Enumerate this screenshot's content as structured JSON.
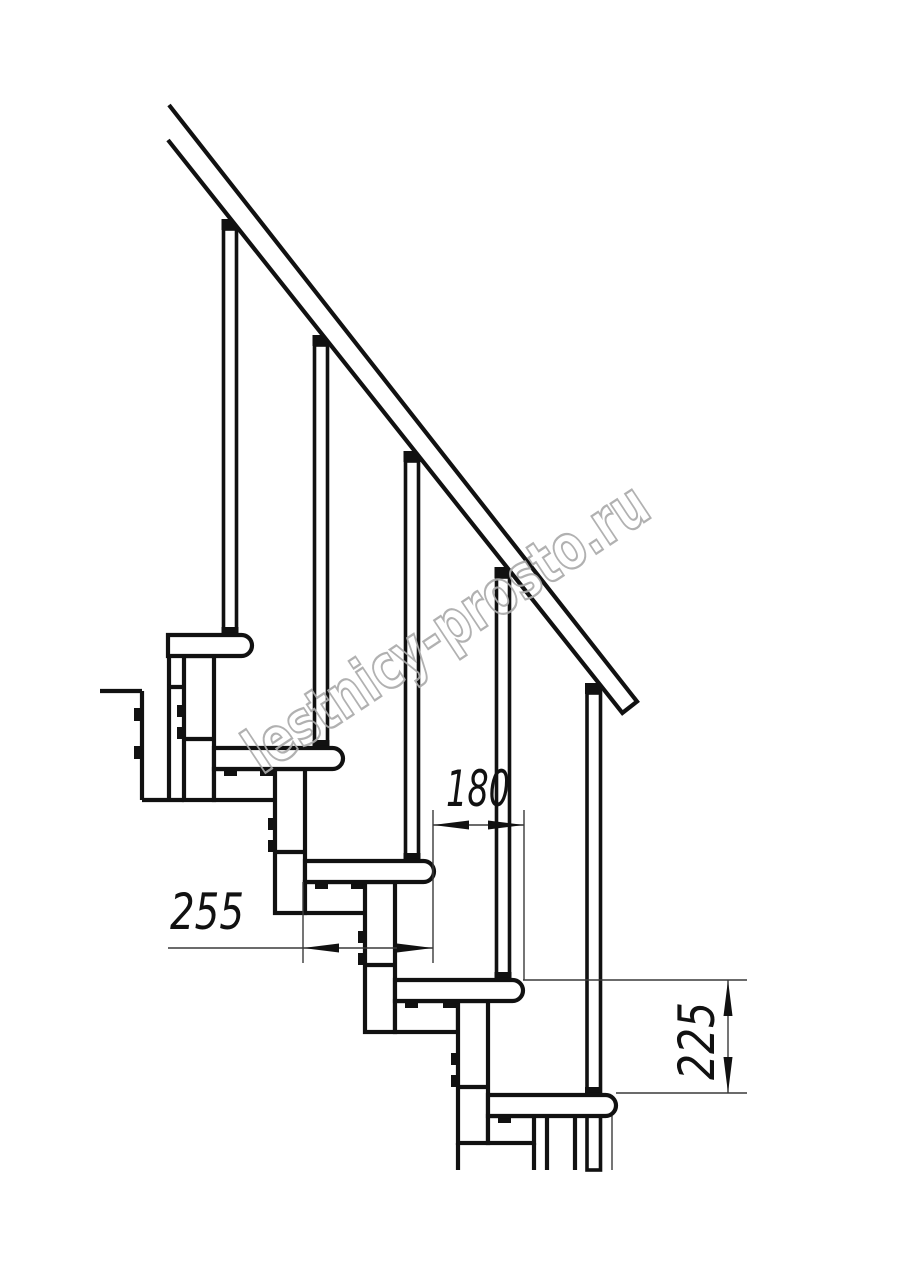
{
  "page": {
    "background": "#ffffff",
    "type": "staircase-technical-drawing"
  },
  "watermark": {
    "text": "lestnicy-prosto.ru",
    "color": "#ababab"
  },
  "drawing": {
    "line_color": "#111111",
    "steps_count": "5"
  },
  "dimensions": {
    "step_run": {
      "label": "180"
    },
    "tread_depth": {
      "label": "255"
    },
    "riser_height": {
      "label": "225"
    }
  }
}
